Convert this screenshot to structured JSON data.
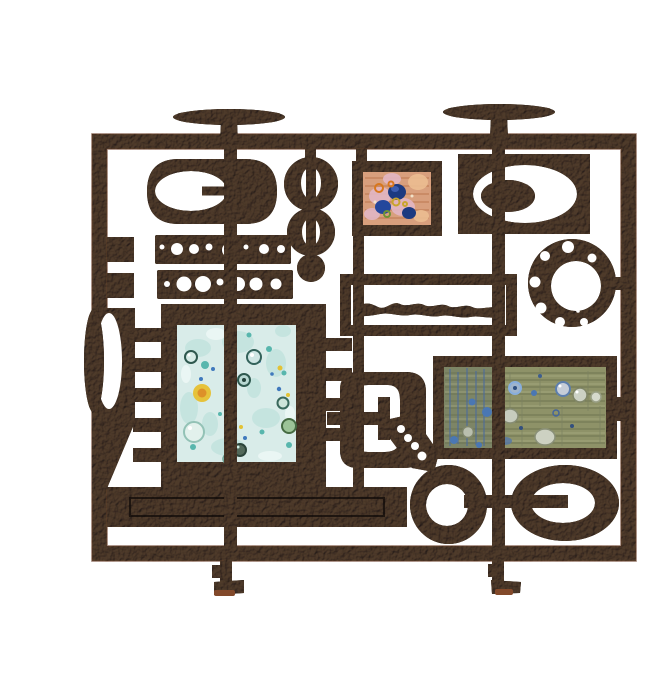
{
  "artwork": {
    "description": "Black hammered wrought-iron fire screen with abstract pierced shapes, two flat-topped candle posts, pierced bars and rings, and inset enamel panels (pink-orange tile, pale blue double panel, olive-green double panel)",
    "parts": [
      "screen-frame",
      "left-candle-post",
      "right-candle-post",
      "oval-cutout-plaque",
      "pierced-bar-top",
      "pierced-bar-bottom",
      "ring-chain",
      "orange-enamel-tile",
      "oval-window-plaque",
      "pierced-ring",
      "wavy-line-box",
      "blue-enamel-panel",
      "green-enamel-panel",
      "lens-slab",
      "buckle-plaque",
      "heavy-bottom-bar",
      "double-ring-motif",
      "left-foot",
      "right-foot"
    ]
  },
  "palette": {
    "bg": "#ffffff",
    "metal": "#1f1712",
    "metal_deep": "#120c08",
    "metal_glow": "#4a3622",
    "rust_edge": "#6b3016",
    "foot_pad": "#82492a",
    "enamel_blue": "#d9ece9",
    "enamel_orange": "#d89f7d",
    "enamel_green": "#8e9268"
  }
}
